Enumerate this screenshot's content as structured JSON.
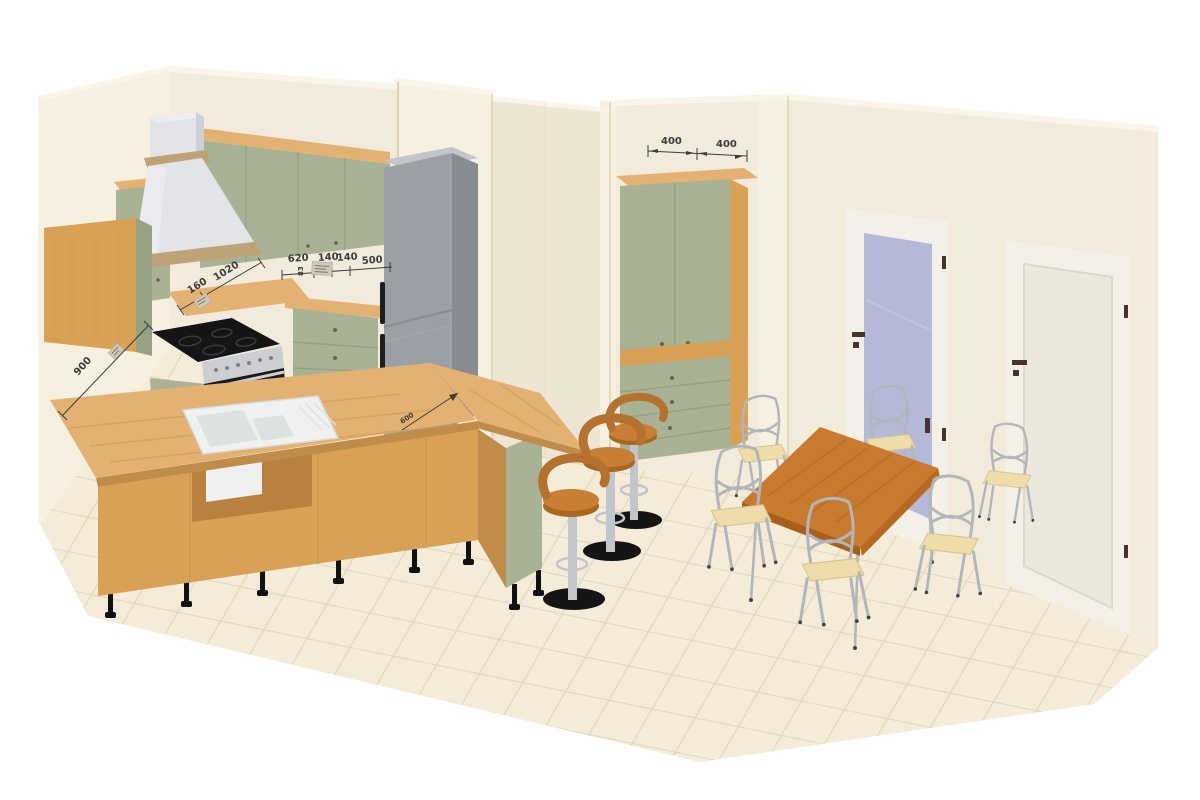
{
  "scene": {
    "title": "3D kitchen plan render",
    "annotations": {
      "pantry_left": "400",
      "pantry_right": "400",
      "run_620": "620",
      "run_140a": "140",
      "run_140b": "140",
      "run_500": "500",
      "height_83": "83",
      "run_160": "160",
      "run_1020": "1020",
      "wall_900": "900",
      "fridge_600": "600"
    },
    "colors": {
      "wall": "#f2ebdb",
      "wallLight": "#f6f0e1",
      "wallShade": "#eee6d4",
      "wallEdge": "#ddd2ba",
      "wallTop": "#faf5e9",
      "floor": "#f4ecd8",
      "tileLine": "#e2d7bd",
      "green": "#a9b295",
      "greenDark": "#97a284",
      "greenLight": "#b6bfa4",
      "wood": "#d9a155",
      "woodTop": "#e3b172",
      "woodDark": "#c08c49",
      "woodInside": "#b8813d",
      "tableWood": "#c87a2e",
      "tableEdge": "#a85f1b",
      "fridge": "#9aa0a6",
      "fridgeTop": "#c2c5c9",
      "fridgeSide": "#868c92",
      "hood": "#e2e4e8",
      "hoodSide": "#cdd0d6",
      "hoodTrim": "#bfa276",
      "steel": "#ccced2",
      "dark": "#151515",
      "sink": "#eff1f0",
      "sinkInner": "#dde1e1",
      "doorWhite": "#f3f0e8",
      "doorPanel": "#ece8dd",
      "glass": "#b5b9d8",
      "chrome": "#c2c5c9",
      "stoolSeat": "#c97f33",
      "stoolSeatDark": "#a8691e",
      "stoolBack": "#b5722e",
      "chairFrame": "#b3b6b9",
      "chairSeat": "#eedcab",
      "dimColor": "#3c3c3c",
      "handle": "#4a332a",
      "tag": "#cfc9ba"
    }
  }
}
